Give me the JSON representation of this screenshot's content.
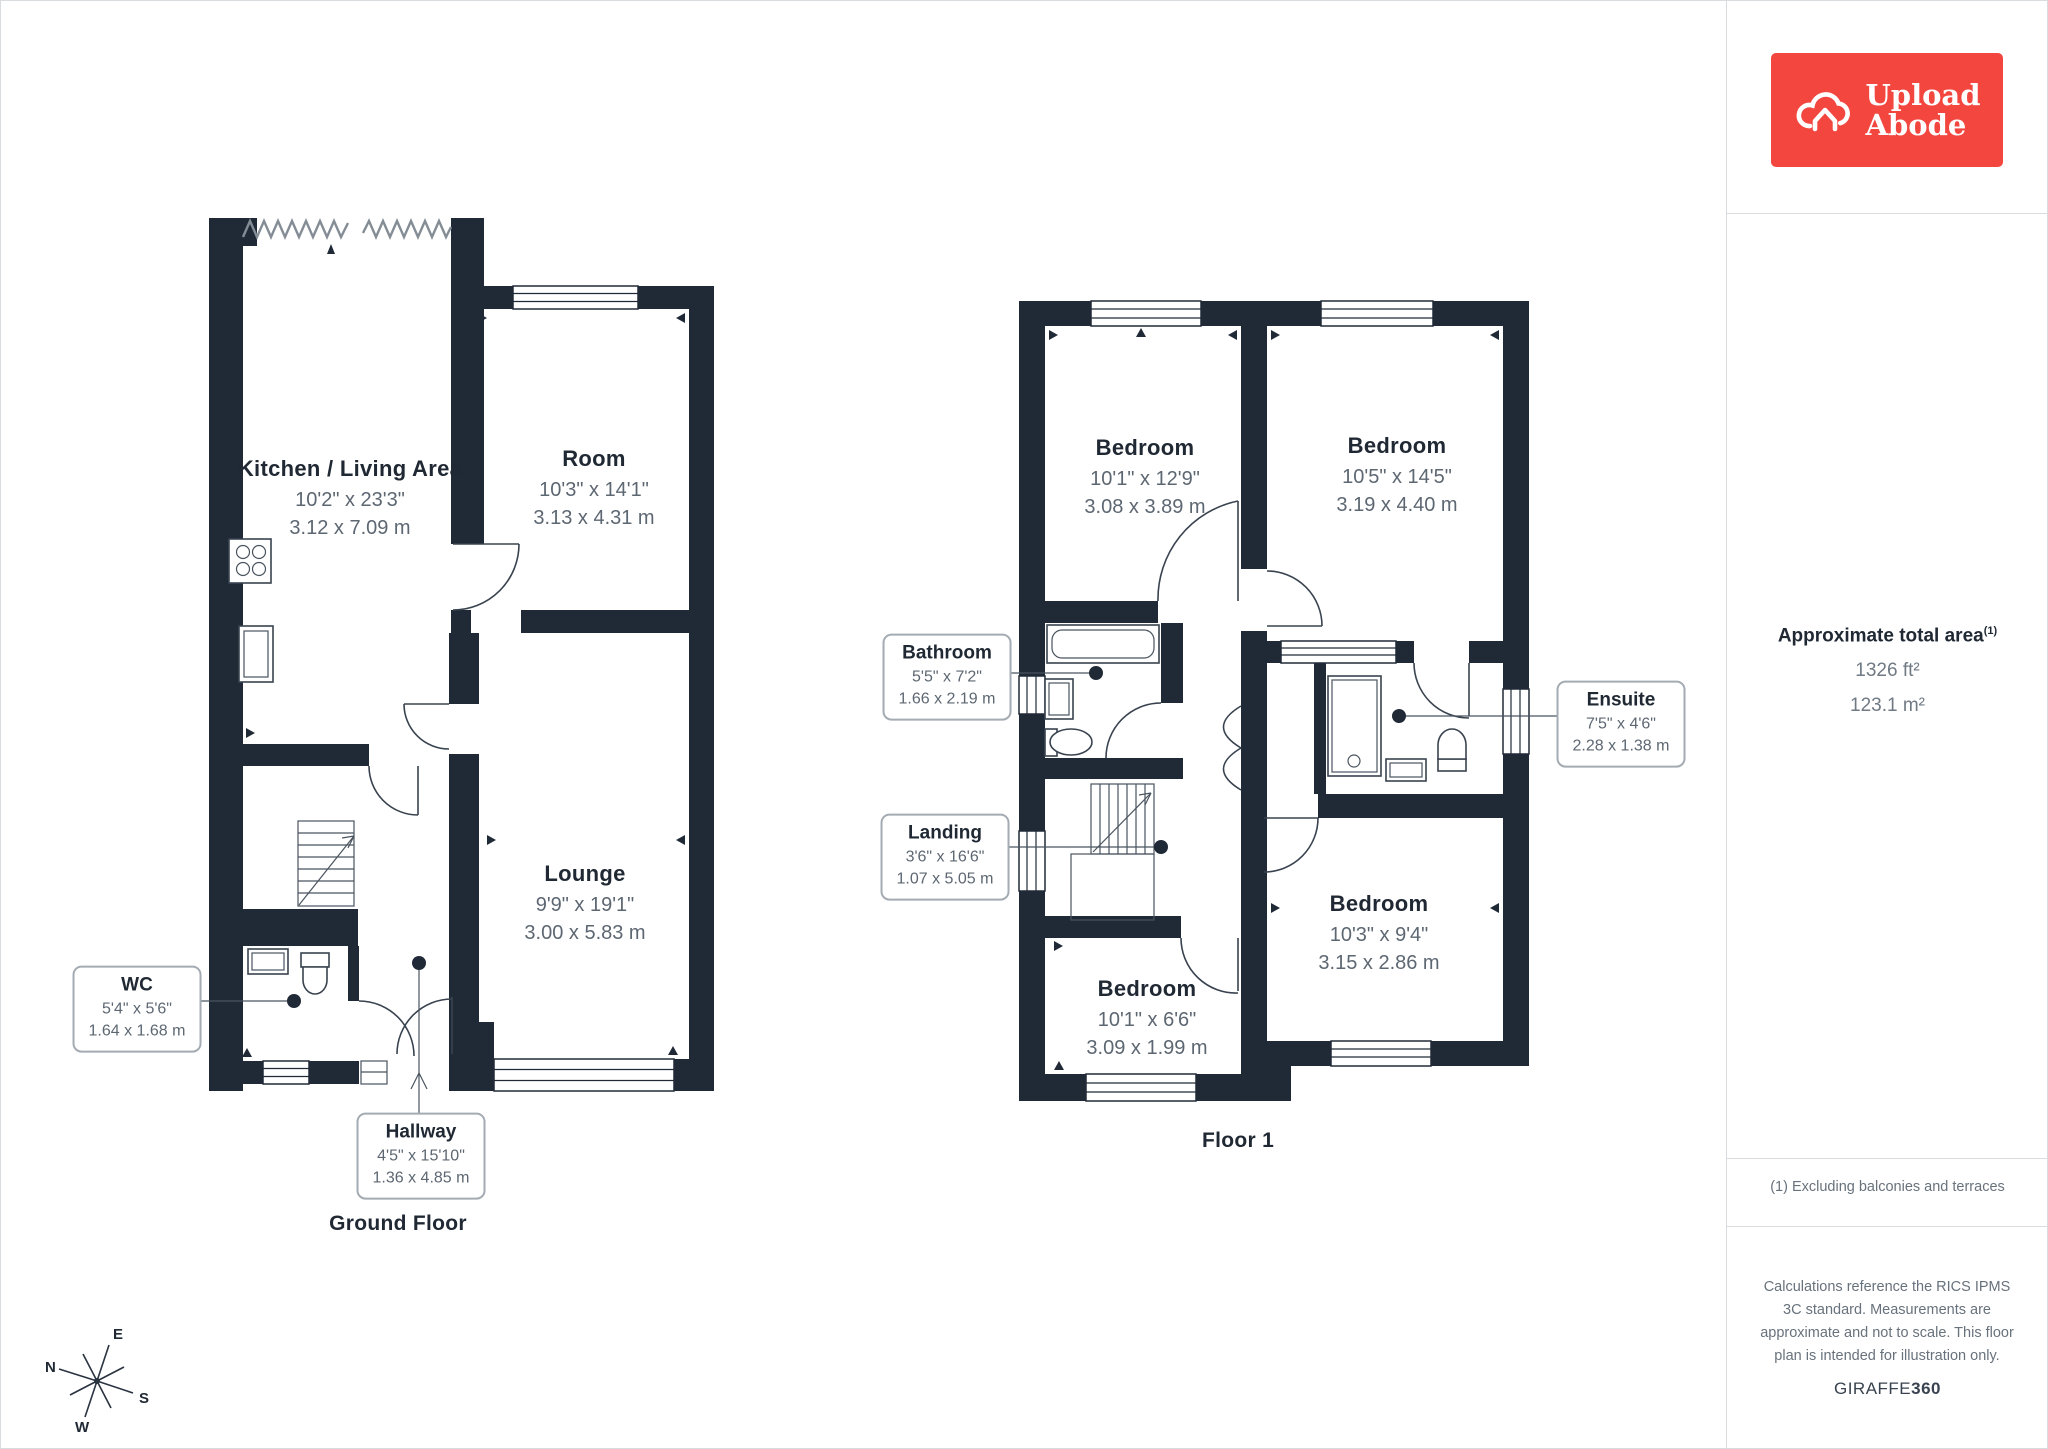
{
  "logo": {
    "line1": "Upload",
    "line2": "Abode"
  },
  "sidebar": {
    "area_title": "Approximate total area",
    "area_sup": "(1)",
    "area_ft": "1326 ft²",
    "area_m": "123.1 m²",
    "footnote": "(1) Excluding balconies and terraces",
    "disclaimer": "Calculations reference the RICS IPMS 3C standard. Measurements are approximate and not to scale. This floor plan is intended for illustration only.",
    "brand": "GIRAFFE",
    "brand_bold": "360"
  },
  "floors": {
    "ground": {
      "title": "Ground Floor"
    },
    "first": {
      "title": "Floor 1"
    }
  },
  "rooms": {
    "kitchen": {
      "name": "Kitchen / Living Area",
      "imperial": "10'2\" x 23'3\"",
      "metric": "3.12 x 7.09 m"
    },
    "room": {
      "name": "Room",
      "imperial": "10'3\" x 14'1\"",
      "metric": "3.13 x 4.31 m"
    },
    "lounge": {
      "name": "Lounge",
      "imperial": "9'9\" x 19'1\"",
      "metric": "3.00 x 5.83 m"
    },
    "bed_nw": {
      "name": "Bedroom",
      "imperial": "10'1\" x 12'9\"",
      "metric": "3.08 x 3.89 m"
    },
    "bed_ne": {
      "name": "Bedroom",
      "imperial": "10'5\" x 14'5\"",
      "metric": "3.19 x 4.40 m"
    },
    "bed_se": {
      "name": "Bedroom",
      "imperial": "10'3\" x 9'4\"",
      "metric": "3.15 x 2.86 m"
    },
    "bed_sw": {
      "name": "Bedroom",
      "imperial": "10'1\" x 6'6\"",
      "metric": "3.09 x 1.99 m"
    }
  },
  "callouts": {
    "wc": {
      "name": "WC",
      "imperial": "5'4\" x 5'6\"",
      "metric": "1.64 x 1.68 m"
    },
    "hallway": {
      "name": "Hallway",
      "imperial": "4'5\" x 15'10\"",
      "metric": "1.36 x 4.85 m"
    },
    "bathroom": {
      "name": "Bathroom",
      "imperial": "5'5\" x 7'2\"",
      "metric": "1.66 x 2.19 m"
    },
    "landing": {
      "name": "Landing",
      "imperial": "3'6\" x 16'6\"",
      "metric": "1.07 x 5.05 m"
    },
    "ensuite": {
      "name": "Ensuite",
      "imperial": "7'5\" x 4'6\"",
      "metric": "2.28 x 1.38 m"
    }
  },
  "compass": {
    "n": "N",
    "e": "E",
    "s": "S",
    "w": "W"
  }
}
